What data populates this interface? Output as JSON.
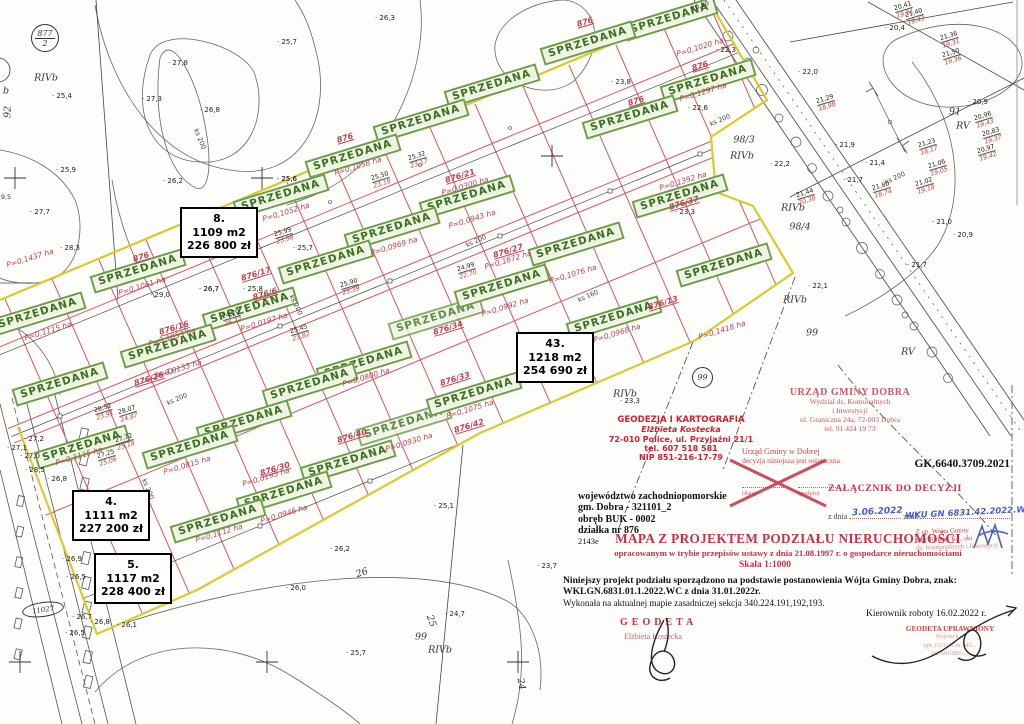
{
  "map": {
    "sold_label": "SPRZEDANA",
    "badge_border_color": "#6f9e48",
    "badge_text_color": "#3a7021",
    "parcel_line_color": "#cf5868",
    "boundary_color": "#d9cb2e",
    "badges": [
      {
        "x": 670,
        "y": 19
      },
      {
        "x": 588,
        "y": 43
      },
      {
        "x": 708,
        "y": 81
      },
      {
        "x": 492,
        "y": 86
      },
      {
        "x": 630,
        "y": 117
      },
      {
        "x": 421,
        "y": 121
      },
      {
        "x": 353,
        "y": 156
      },
      {
        "x": 281,
        "y": 196
      },
      {
        "x": 467,
        "y": 197
      },
      {
        "x": 680,
        "y": 196
      },
      {
        "x": 392,
        "y": 229
      },
      {
        "x": 576,
        "y": 244
      },
      {
        "x": 326,
        "y": 262
      },
      {
        "x": 138,
        "y": 271
      },
      {
        "x": 724,
        "y": 265
      },
      {
        "x": 38,
        "y": 314
      },
      {
        "x": 250,
        "y": 309
      },
      {
        "x": 614,
        "y": 318
      },
      {
        "x": 436,
        "y": 318,
        "o": 0.8
      },
      {
        "x": 168,
        "y": 346
      },
      {
        "x": 502,
        "y": 286
      },
      {
        "x": 364,
        "y": 363
      },
      {
        "x": 60,
        "y": 384
      },
      {
        "x": 310,
        "y": 385
      },
      {
        "x": 244,
        "y": 422
      },
      {
        "x": 404,
        "y": 424,
        "o": 0.82
      },
      {
        "x": 82,
        "y": 447
      },
      {
        "x": 190,
        "y": 447
      },
      {
        "x": 348,
        "y": 462
      },
      {
        "x": 474,
        "y": 394
      },
      {
        "x": 284,
        "y": 493
      },
      {
        "x": 218,
        "y": 521
      }
    ],
    "price_boxes": [
      {
        "number": "8.",
        "area": "1109 m2",
        "price": "226 800 zł",
        "x": 180,
        "y": 207
      },
      {
        "number": "43.",
        "area": "1218 m2",
        "price": "254 690 zł",
        "x": 516,
        "y": 332
      },
      {
        "number": "4.",
        "area": "1111 m2",
        "price": "227 200 zł",
        "x": 72,
        "y": 490
      },
      {
        "number": "5.",
        "area": "1117 m2",
        "price": "228 400 zł",
        "x": 94,
        "y": 553
      }
    ],
    "labels": [
      {
        "t": "P=0,1437 ha",
        "x": 30,
        "y": 258,
        "k": "area"
      },
      {
        "t": "P=0,1061 ha",
        "x": 142,
        "y": 286,
        "k": "area"
      },
      {
        "t": "P=0,1115 ha",
        "x": 48,
        "y": 331,
        "k": "area"
      },
      {
        "t": "P=0,1053 ha",
        "x": 172,
        "y": 337,
        "k": "area"
      },
      {
        "t": "P=0,1052 ha",
        "x": 286,
        "y": 212,
        "k": "area"
      },
      {
        "t": "P=0,1058 ha",
        "x": 358,
        "y": 166,
        "k": "area"
      },
      {
        "t": "P=0,0969 ha",
        "x": 394,
        "y": 246,
        "k": "area"
      },
      {
        "t": "P=0,0197 ha",
        "x": 264,
        "y": 322,
        "k": "area"
      },
      {
        "t": "P=0,0943 ha",
        "x": 472,
        "y": 219,
        "k": "area"
      },
      {
        "t": "P=0,1872 ha",
        "x": 508,
        "y": 260,
        "k": "area"
      },
      {
        "t": "P=0,0300 ha",
        "x": 465,
        "y": 186,
        "k": "area"
      },
      {
        "t": "P=0,1076 ha",
        "x": 573,
        "y": 274,
        "k": "area"
      },
      {
        "t": "P=0,0992 ha",
        "x": 505,
        "y": 307,
        "k": "area"
      },
      {
        "t": "P=0,0968 ha",
        "x": 617,
        "y": 333,
        "k": "area"
      },
      {
        "t": "P=0,1418 ha",
        "x": 722,
        "y": 330,
        "k": "area"
      },
      {
        "t": "P=0,1392 ha",
        "x": 683,
        "y": 181,
        "k": "area"
      },
      {
        "t": "P=0,1297 ha",
        "x": 703,
        "y": 92,
        "k": "area"
      },
      {
        "t": "P=0,1020 ha",
        "x": 700,
        "y": 47,
        "k": "area"
      },
      {
        "t": "P=0,0815 ha",
        "x": 187,
        "y": 465,
        "k": "area"
      },
      {
        "t": "P=0,0195 ha",
        "x": 266,
        "y": 477,
        "k": "area"
      },
      {
        "t": "P=0,0946 ha",
        "x": 284,
        "y": 514,
        "k": "area"
      },
      {
        "t": "P=0,1112 ha",
        "x": 219,
        "y": 533,
        "k": "area"
      },
      {
        "t": "P=0,0800 ha",
        "x": 366,
        "y": 377,
        "k": "area"
      },
      {
        "t": "P=0,0930 ha",
        "x": 409,
        "y": 442,
        "k": "area"
      },
      {
        "t": "P=0,1075 ha",
        "x": 470,
        "y": 409,
        "k": "area"
      },
      {
        "t": "P=0,0133 ha",
        "x": 178,
        "y": 369,
        "k": "area"
      },
      {
        "t": "P=0,1115 ha",
        "x": 79,
        "y": 456,
        "k": "area"
      },
      {
        "t": "876/6",
        "x": 265,
        "y": 294,
        "k": "parcel"
      },
      {
        "t": "876/16",
        "x": 174,
        "y": 328,
        "k": "parcel"
      },
      {
        "t": "876/17",
        "x": 256,
        "y": 274,
        "k": "parcel"
      },
      {
        "t": "876/21",
        "x": 460,
        "y": 176,
        "k": "parcel"
      },
      {
        "t": "876/27",
        "x": 508,
        "y": 251,
        "k": "parcel"
      },
      {
        "t": "876/13",
        "x": 663,
        "y": 303,
        "k": "parcel"
      },
      {
        "t": "876/26",
        "x": 149,
        "y": 379,
        "k": "parcel"
      },
      {
        "t": "876/30",
        "x": 275,
        "y": 469,
        "k": "parcel"
      },
      {
        "t": "876/33",
        "x": 455,
        "y": 379,
        "k": "parcel"
      },
      {
        "t": "876/34",
        "x": 448,
        "y": 328,
        "k": "parcel"
      },
      {
        "t": "876/40",
        "x": 352,
        "y": 436,
        "k": "parcel"
      },
      {
        "t": "876/42",
        "x": 469,
        "y": 426,
        "k": "parcel"
      },
      {
        "t": "876/37",
        "x": 684,
        "y": 203,
        "k": "parcel"
      },
      {
        "t": "876",
        "x": 585,
        "y": 22,
        "k": "parcel"
      },
      {
        "t": "876",
        "x": 700,
        "y": 66,
        "k": "parcel"
      },
      {
        "t": "876",
        "x": 636,
        "y": 101,
        "k": "parcel"
      },
      {
        "t": "876",
        "x": 141,
        "y": 257,
        "k": "parcel"
      },
      {
        "t": "876",
        "x": 345,
        "y": 138,
        "k": "parcel"
      },
      {
        "t": "25,4",
        "x": 62,
        "y": 96,
        "k": "spot"
      },
      {
        "t": "27,8",
        "x": 178,
        "y": 63,
        "k": "spot"
      },
      {
        "t": "27,3",
        "x": 152,
        "y": 99,
        "k": "spot"
      },
      {
        "t": "26,8",
        "x": 210,
        "y": 110,
        "k": "spot"
      },
      {
        "t": "25,7",
        "x": 287,
        "y": 42,
        "k": "spot"
      },
      {
        "t": "26,3",
        "x": 385,
        "y": 18,
        "k": "spot"
      },
      {
        "t": "26,2",
        "x": 173,
        "y": 181,
        "k": "spot"
      },
      {
        "t": "25,9",
        "x": 66,
        "y": 170,
        "k": "spot"
      },
      {
        "t": "27,7",
        "x": 40,
        "y": 212,
        "k": "spot"
      },
      {
        "t": "28,3",
        "x": 70,
        "y": 248,
        "k": "spot"
      },
      {
        "t": "29,0",
        "x": 160,
        "y": 295,
        "k": "spot"
      },
      {
        "t": "26,7",
        "x": 209,
        "y": 289,
        "k": "spot"
      },
      {
        "t": "25,8",
        "x": 253,
        "y": 289,
        "k": "spot"
      },
      {
        "t": "25,6",
        "x": 287,
        "y": 179,
        "k": "spot"
      },
      {
        "t": "25,7",
        "x": 303,
        "y": 248,
        "k": "spot"
      },
      {
        "t": "23,8",
        "x": 621,
        "y": 82,
        "k": "spot"
      },
      {
        "t": "22,6",
        "x": 698,
        "y": 108,
        "k": "spot"
      },
      {
        "t": "22,3",
        "x": 726,
        "y": 50,
        "k": "spot"
      },
      {
        "t": "22,2",
        "x": 780,
        "y": 164,
        "k": "spot"
      },
      {
        "t": "23,3",
        "x": 685,
        "y": 212,
        "k": "spot"
      },
      {
        "t": "22,0",
        "x": 808,
        "y": 72,
        "k": "spot"
      },
      {
        "t": "21,9",
        "x": 845,
        "y": 145,
        "k": "spot"
      },
      {
        "t": "21,4",
        "x": 875,
        "y": 163,
        "k": "spot"
      },
      {
        "t": "20,9",
        "x": 978,
        "y": 102,
        "k": "spot"
      },
      {
        "t": "20,4",
        "x": 895,
        "y": 28,
        "k": "spot"
      },
      {
        "t": "20,9",
        "x": 963,
        "y": 235,
        "k": "spot"
      },
      {
        "t": "21,0",
        "x": 942,
        "y": 222,
        "k": "spot"
      },
      {
        "t": "21,7",
        "x": 853,
        "y": 180,
        "k": "spot"
      },
      {
        "t": "21,7",
        "x": 917,
        "y": 265,
        "k": "spot"
      },
      {
        "t": "22,1",
        "x": 818,
        "y": 286,
        "k": "spot"
      },
      {
        "t": "26,0",
        "x": 296,
        "y": 588,
        "k": "spot"
      },
      {
        "t": "26,1",
        "x": 127,
        "y": 625,
        "k": "spot"
      },
      {
        "t": "26,2",
        "x": 340,
        "y": 549,
        "k": "spot"
      },
      {
        "t": "25,7",
        "x": 356,
        "y": 653,
        "k": "spot"
      },
      {
        "t": "24,7",
        "x": 455,
        "y": 614,
        "k": "spot"
      },
      {
        "t": "23,7",
        "x": 547,
        "y": 566,
        "k": "spot"
      },
      {
        "t": "25,1",
        "x": 444,
        "y": 506,
        "k": "spot"
      },
      {
        "t": "26,9",
        "x": 72,
        "y": 559,
        "k": "spot"
      },
      {
        "t": "26,5",
        "x": 76,
        "y": 577,
        "k": "spot"
      },
      {
        "t": "26,8",
        "x": 57,
        "y": 479,
        "k": "spot"
      },
      {
        "t": "27,2",
        "x": 34,
        "y": 439,
        "k": "spot"
      },
      {
        "t": "27,1",
        "x": 17,
        "y": 448,
        "k": "spot"
      },
      {
        "t": "27,0",
        "x": 30,
        "y": 456,
        "k": "spot"
      },
      {
        "t": "28,5",
        "x": 35,
        "y": 470,
        "k": "spot"
      },
      {
        "t": "26,7",
        "x": 82,
        "y": 617,
        "k": "spot"
      },
      {
        "t": "26,8",
        "x": 100,
        "y": 622,
        "k": "spot"
      },
      {
        "t": "26,5",
        "x": 75,
        "y": 633,
        "k": "spot"
      },
      {
        "t": "23,3",
        "x": 630,
        "y": 401,
        "k": "spot"
      },
      {
        "t": "25,6",
        "x": 287,
        "y": 179,
        "k": "spot"
      },
      {
        "t": "26,7",
        "x": 209,
        "y": 289,
        "k": "spot"
      },
      {
        "t": "RIVb",
        "x": 46,
        "y": 78,
        "k": "zone"
      },
      {
        "t": "RIVb",
        "x": 742,
        "y": 156,
        "k": "zone"
      },
      {
        "t": "RIVb",
        "x": 793,
        "y": 208,
        "k": "zone"
      },
      {
        "t": "RIVb",
        "x": 795,
        "y": 300,
        "k": "zone"
      },
      {
        "t": "RIVb",
        "x": 625,
        "y": 394,
        "k": "zone"
      },
      {
        "t": "RIVb",
        "x": 440,
        "y": 650,
        "k": "zone"
      },
      {
        "t": "RV",
        "x": 963,
        "y": 126,
        "k": "zone"
      },
      {
        "t": "RV",
        "x": 908,
        "y": 352,
        "k": "zone"
      },
      {
        "t": "91",
        "x": 955,
        "y": 112,
        "k": "zone"
      },
      {
        "t": "99",
        "x": 812,
        "y": 333,
        "k": "zone"
      },
      {
        "t": "99",
        "x": 421,
        "y": 637,
        "k": "zone"
      },
      {
        "t": "98/3",
        "x": 744,
        "y": 140,
        "k": "zone"
      },
      {
        "t": "98/4",
        "x": 800,
        "y": 227,
        "k": "zone"
      },
      {
        "t": "26",
        "x": 362,
        "y": 573,
        "k": "zone",
        "r": -20
      },
      {
        "t": "25",
        "x": 431,
        "y": 621,
        "k": "zone",
        "r": 70
      },
      {
        "t": "24",
        "x": 521,
        "y": 684,
        "k": "zone",
        "r": 80
      },
      {
        "t": "92",
        "x": 8,
        "y": 112,
        "k": "zone",
        "r": -88
      },
      {
        "t": "b",
        "x": 6,
        "y": 91,
        "k": "zone"
      },
      {
        "t": "ks 200",
        "x": 177,
        "y": 399,
        "k": "ks",
        "r": -23
      },
      {
        "t": "ks 200",
        "x": 720,
        "y": 120,
        "k": "ks",
        "r": -23
      },
      {
        "t": "ks 200",
        "x": 476,
        "y": 241,
        "k": "ks",
        "r": -23
      },
      {
        "t": "ks 200",
        "x": 895,
        "y": 178,
        "k": "ks",
        "r": -25
      },
      {
        "t": "ks 200",
        "x": 296,
        "y": 305,
        "k": "ks",
        "r": 65
      },
      {
        "t": "ks 200",
        "x": 200,
        "y": 139,
        "k": "ks",
        "r": 68
      },
      {
        "t": "ks 200",
        "x": 148,
        "y": 489,
        "k": "ks",
        "r": 68
      },
      {
        "t": "ks 160",
        "x": 588,
        "y": 296,
        "k": "ks",
        "r": -23
      },
      {
        "t": "20,10",
        "x": 700,
        "y": 6,
        "k": "plain",
        "r": -20
      },
      {
        "t": "9,5",
        "x": 6,
        "y": 197,
        "k": "plain"
      }
    ],
    "pairs": [
      {
        "a": "28,52",
        "b": "23,91",
        "x": 104,
        "y": 412
      },
      {
        "a": "28,07",
        "b": "24,87",
        "x": 128,
        "y": 414
      },
      {
        "a": "27,72",
        "b": "25,18",
        "x": 125,
        "y": 442
      },
      {
        "a": "27,25",
        "b": "25,06",
        "x": 107,
        "y": 458
      },
      {
        "a": "25,99",
        "b": "23,98",
        "x": 284,
        "y": 236
      },
      {
        "a": "25,50",
        "b": "23,18",
        "x": 381,
        "y": 180
      },
      {
        "a": "25,32",
        "b": "23,17",
        "x": 418,
        "y": 160
      },
      {
        "a": "25,90",
        "b": "23,39",
        "x": 350,
        "y": 287
      },
      {
        "a": "25,45",
        "b": "23,82",
        "x": 300,
        "y": 333
      },
      {
        "a": "24,70",
        "b": "26,22",
        "x": 232,
        "y": 318
      },
      {
        "a": "24,99",
        "b": "22,70",
        "x": 467,
        "y": 271
      },
      {
        "a": "21,40",
        "b": "19,43",
        "x": 915,
        "y": 17
      },
      {
        "a": "21,36",
        "b": "19,31",
        "x": 950,
        "y": 40
      },
      {
        "a": "21,50",
        "b": "19,36",
        "x": 952,
        "y": 57
      },
      {
        "a": "21,23",
        "b": "18,17",
        "x": 928,
        "y": 147
      },
      {
        "a": "21,06",
        "b": "19,05",
        "x": 938,
        "y": 168
      },
      {
        "a": "21,02",
        "b": "19,18",
        "x": 925,
        "y": 186
      },
      {
        "a": "21,80",
        "b": "18,74",
        "x": 882,
        "y": 190
      },
      {
        "a": "20,96",
        "b": "19,43",
        "x": 984,
        "y": 120
      },
      {
        "a": "20,83",
        "b": "19,37",
        "x": 992,
        "y": 136
      },
      {
        "a": "20,97",
        "b": "19,42",
        "x": 987,
        "y": 153
      },
      {
        "a": "21,29",
        "b": "18,98",
        "x": 826,
        "y": 103
      },
      {
        "a": "21,44",
        "b": "20,38",
        "x": 806,
        "y": 197
      },
      {
        "a": "20,41",
        "b": "19,51",
        "x": 904,
        "y": 10
      }
    ],
    "circled": [
      {
        "top": "877",
        "bottom": "2"
      },
      {
        "text": "99"
      },
      {
        "text": "11027"
      }
    ]
  },
  "doc": {
    "stamp_geo": [
      "GEODEZJA I KARTOGRAFIA",
      "Elżbieta Kostecka",
      "72-010 Police, ul. Przyjaźni 21/1",
      "tel. 607 518 581",
      "NIP 851-216-17-79"
    ],
    "stamp_ugd": [
      "URZĄD GMINY DOBRA",
      "Wydział ds. Komunalnych",
      "i Inwestycji",
      "ul. Graniczna 24a, 72-003 Dobra",
      "tel. 91 424 19 73"
    ],
    "stamp_final": [
      "Urząd Gminy w Dobrej",
      "decyzja niniejsza jest ostateczna"
    ],
    "data_label": "(data)",
    "podpis_label": "(podpis)",
    "case_no": "GK.6640.3709.2021",
    "annex": "ZAŁĄCZNIK DO DECYZJI",
    "z_dnia_label": "z dnia",
    "znak_label": "znak",
    "hw_date": "3.06.2022",
    "hw_znak": "WKU GN 6831.42.2022.WC",
    "stamp_wojt": [
      "Z up. Wójta Gminy",
      "mgr Tomasz Ka...ski",
      "ds. Komunalnych i Inwestycji"
    ],
    "info": [
      "województwo zachodniopomorskie",
      "gm. Dobra - 321101_2",
      "obręb BUK - 0002",
      "działka nr 876",
      "2143e"
    ],
    "title": "MAPA  Z  PROJEKTEM  PODZIAŁU  NIERUCHOMOŚCI",
    "subtitle": "opracowanym w trybie przepisów ustawy z dnia 21.08.1997 r. o gospodarce nieruchomościami",
    "scale": "Skala 1:1000",
    "body1": "Niniejszy  projekt  podziału  sporządzono  na  podstawie  postanowienia  Wójta  Gminy  Dobra,  znak:",
    "body2": "WKLGN.6831.01.1.2022.WC z  dnia  31.01.2022r.",
    "body3": "Wykonała na aktualnej mapie zasadniczej sekcja 340.224.191,192,193.",
    "geodeta": "GEODETA",
    "geodeta_name": "Elżbieta Kostecka",
    "kierownik": "Kierownik roboty  16.02.2022 r.",
    "stamp_upr": [
      "GEODETA UPRAWNIONY",
      "Wojciech ...",
      "upr. GUGiK nr 445...",
      "tel. 601-885-..."
    ]
  }
}
